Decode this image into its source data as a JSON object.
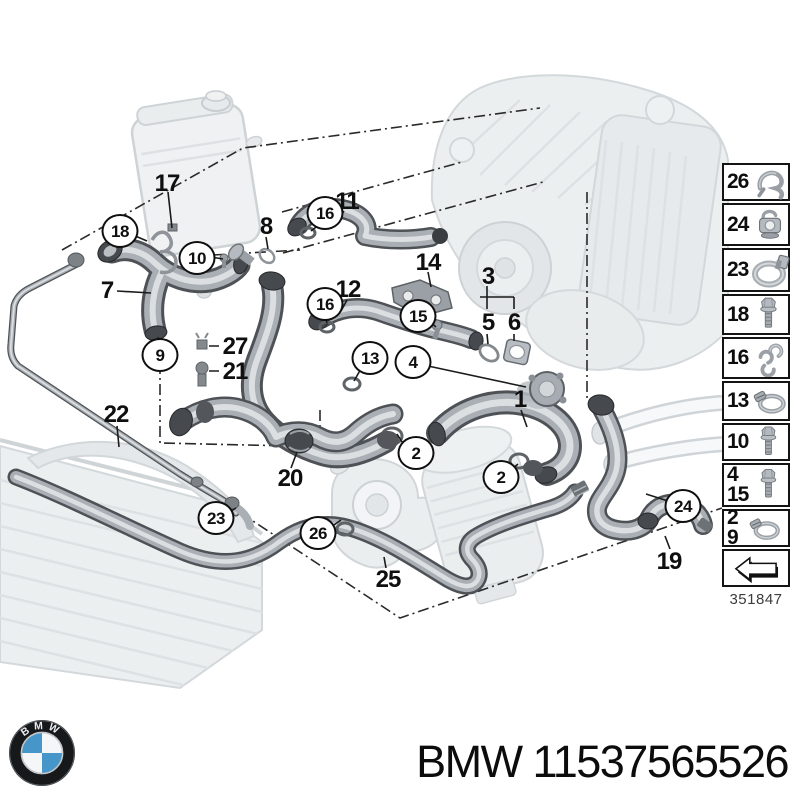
{
  "brand": {
    "name": "BMW",
    "part_number": "11537565526",
    "part_label": "BMW 11537565526",
    "roundel_letters": "BMW"
  },
  "colors": {
    "bmw_blue": "#4796c9",
    "ink": "#0f0f0f"
  },
  "sidebar": {
    "diagram_number": "351847",
    "items": [
      {
        "labels": [
          "26"
        ],
        "icon": "spring-clip"
      },
      {
        "labels": [
          "24"
        ],
        "icon": "holder-clip"
      },
      {
        "labels": [
          "23"
        ],
        "icon": "clamp-ring"
      },
      {
        "labels": [
          "18"
        ],
        "icon": "flange-bolt"
      },
      {
        "labels": [
          "16"
        ],
        "icon": "retainer-clip"
      },
      {
        "labels": [
          "13"
        ],
        "icon": "hose-clamp"
      },
      {
        "labels": [
          "10"
        ],
        "icon": "hex-bolt"
      },
      {
        "labels": [
          "4",
          "15"
        ],
        "icon": "flange-bolt"
      },
      {
        "labels": [
          "2",
          "9"
        ],
        "icon": "hose-clamp"
      }
    ]
  },
  "callouts": [
    {
      "label": "17",
      "circled": false,
      "x": 167,
      "y": 184
    },
    {
      "label": "18",
      "circled": true,
      "x": 120,
      "y": 231
    },
    {
      "label": "10",
      "circled": true,
      "x": 197,
      "y": 258
    },
    {
      "label": "8",
      "circled": false,
      "x": 266,
      "y": 227
    },
    {
      "label": "7",
      "circled": false,
      "x": 107,
      "y": 291
    },
    {
      "label": "11",
      "circled": false,
      "x": 347,
      "y": 202
    },
    {
      "label": "16",
      "circled": true,
      "x": 325,
      "y": 213
    },
    {
      "label": "12",
      "circled": false,
      "x": 348,
      "y": 290
    },
    {
      "label": "16",
      "circled": true,
      "x": 325,
      "y": 304
    },
    {
      "label": "14",
      "circled": false,
      "x": 428,
      "y": 263
    },
    {
      "label": "3",
      "circled": false,
      "x": 488,
      "y": 277
    },
    {
      "label": "5",
      "circled": false,
      "x": 488,
      "y": 323
    },
    {
      "label": "6",
      "circled": false,
      "x": 514,
      "y": 323
    },
    {
      "label": "15",
      "circled": true,
      "x": 418,
      "y": 316
    },
    {
      "label": "13",
      "circled": true,
      "x": 370,
      "y": 358
    },
    {
      "label": "4",
      "circled": true,
      "x": 413,
      "y": 362
    },
    {
      "label": "9",
      "circled": true,
      "x": 160,
      "y": 355
    },
    {
      "label": "27",
      "circled": false,
      "x": 235,
      "y": 347
    },
    {
      "label": "21",
      "circled": false,
      "x": 235,
      "y": 372
    },
    {
      "label": "22",
      "circled": false,
      "x": 116,
      "y": 415
    },
    {
      "label": "20",
      "circled": false,
      "x": 290,
      "y": 479
    },
    {
      "label": "23",
      "circled": true,
      "x": 216,
      "y": 518
    },
    {
      "label": "26",
      "circled": true,
      "x": 318,
      "y": 533
    },
    {
      "label": "1",
      "circled": false,
      "x": 520,
      "y": 400
    },
    {
      "label": "2",
      "circled": true,
      "x": 416,
      "y": 453
    },
    {
      "label": "2",
      "circled": true,
      "x": 501,
      "y": 477
    },
    {
      "label": "25",
      "circled": false,
      "x": 388,
      "y": 580
    },
    {
      "label": "24",
      "circled": true,
      "x": 683,
      "y": 506
    },
    {
      "label": "19",
      "circled": false,
      "x": 669,
      "y": 562
    }
  ]
}
